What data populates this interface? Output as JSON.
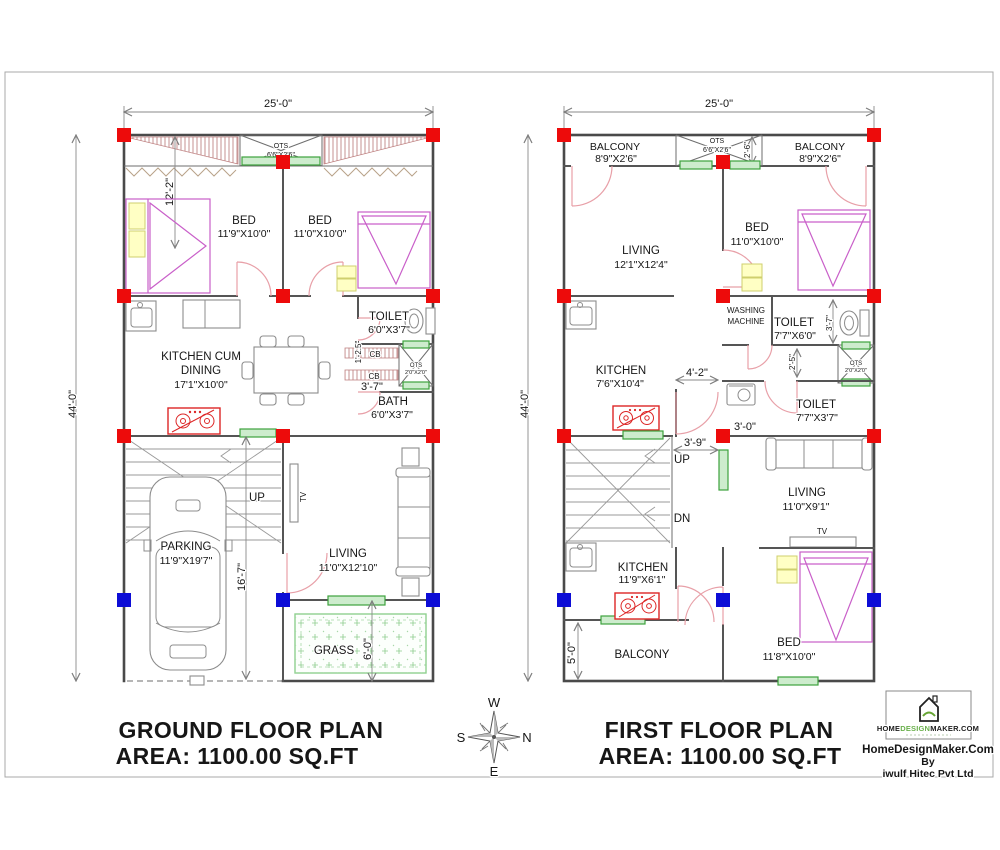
{
  "gf": {
    "dim_width": "25'-0\"",
    "dim_height": "44'-0\"",
    "ots_label": "OTS",
    "ots_size": "6'6\"X2'6\"",
    "bed_left_label": "BED",
    "bed_left_size": "11'9\"X10'0\"",
    "bed_right_label": "BED",
    "bed_right_size": "11'0\"X10'0\"",
    "bed_dim": "12'-2\"",
    "kitchen_line1": "KITCHEN CUM",
    "kitchen_line2": "DINING",
    "kitchen_size": "17'1\"X10'0\"",
    "toilet_label": "TOILET",
    "toilet_size": "6'0\"X3'7\"",
    "cb_dim": "1'-2.5\"",
    "cb1": "CB",
    "cb2": "CB",
    "ots2_label": "OTS",
    "ots2_size": "2'0\"X2'0\"",
    "dim_3_7": "3'-7\"",
    "bath_label": "BATH",
    "bath_size": "6'0\"X3'7\"",
    "up": "UP",
    "tv": "TV",
    "parking_label": "PARKING",
    "parking_size": "11'9\"X19'7\"",
    "dim_16_7": "16'-7\"",
    "living_label": "LIVING",
    "living_size": "11'0\"X12'10\"",
    "grass_label": "GRASS",
    "grass_dim": "6'-0\"",
    "title": "GROUND FLOOR PLAN",
    "area": "AREA: 1100.00 SQ.FT"
  },
  "ff": {
    "dim_width": "25'-0\"",
    "dim_height": "44'-0\"",
    "balcony_left_label": "BALCONY",
    "balcony_left_size": "8'9\"X2'6\"",
    "ots_label": "OTS",
    "ots_size": "6'6\"X2'6\"",
    "ots_dim": "2'-6\"",
    "balcony_right_label": "BALCONY",
    "balcony_right_size": "8'9\"X2'6\"",
    "living_top_label": "LIVING",
    "living_top_size": "12'1\"X12'4\"",
    "bed_top_label": "BED",
    "bed_top_size": "11'0\"X10'0\"",
    "washing_line1": "WASHING",
    "washing_line2": "MACHINE",
    "toilet1_label": "TOILET",
    "toilet1_size": "7'7\"X6'0\"",
    "dim_3_7": "3'-7\"",
    "dim_2_5": "2'-5\"",
    "ots2_label": "OTS",
    "ots2_size": "2'0\"X2'0\"",
    "kitchen_top_label": "KITCHEN",
    "kitchen_top_size": "7'6\"X10'4\"",
    "dim_4_2": "4'-2\"",
    "toilet2_label": "TOILET",
    "toilet2_size": "7'7\"X3'7\"",
    "dim_3_0": "3'-0\"",
    "dim_3_9": "3'-9\"",
    "up": "UP",
    "dn": "DN",
    "living_bottom_label": "LIVING",
    "living_bottom_size": "11'0\"X9'1\"",
    "tv": "TV",
    "kitchen_bottom_label": "KITCHEN",
    "kitchen_bottom_size": "11'9\"X6'1\"",
    "bed_bottom_label": "BED",
    "bed_bottom_size": "11'8\"X10'0\"",
    "balcony_bottom_label": "BALCONY",
    "dim_5_0": "5'-0\"",
    "title": "FIRST FLOOR PLAN",
    "area": "AREA: 1100.00 SQ.FT"
  },
  "compass": {
    "n": "N",
    "s": "S",
    "e": "E",
    "w": "W"
  },
  "logo": {
    "brand_home": "HOME",
    "brand_design": "DESIGN",
    "brand_maker": "MAKER.COM",
    "line1": "HomeDesignMaker.Com",
    "line2": "By",
    "line3": "iwulf Hitec Pvt Ltd"
  },
  "colors": {
    "column_red": "#ed0b0b",
    "column_blue": "#0d0dd6",
    "window_green": "#3da23d",
    "door_pink": "#e8a0a8",
    "furniture_magenta": "#c95fc9",
    "stove_red": "#dd2626",
    "grass_green": "#8fd08f",
    "hatch_brown": "#c08484"
  }
}
